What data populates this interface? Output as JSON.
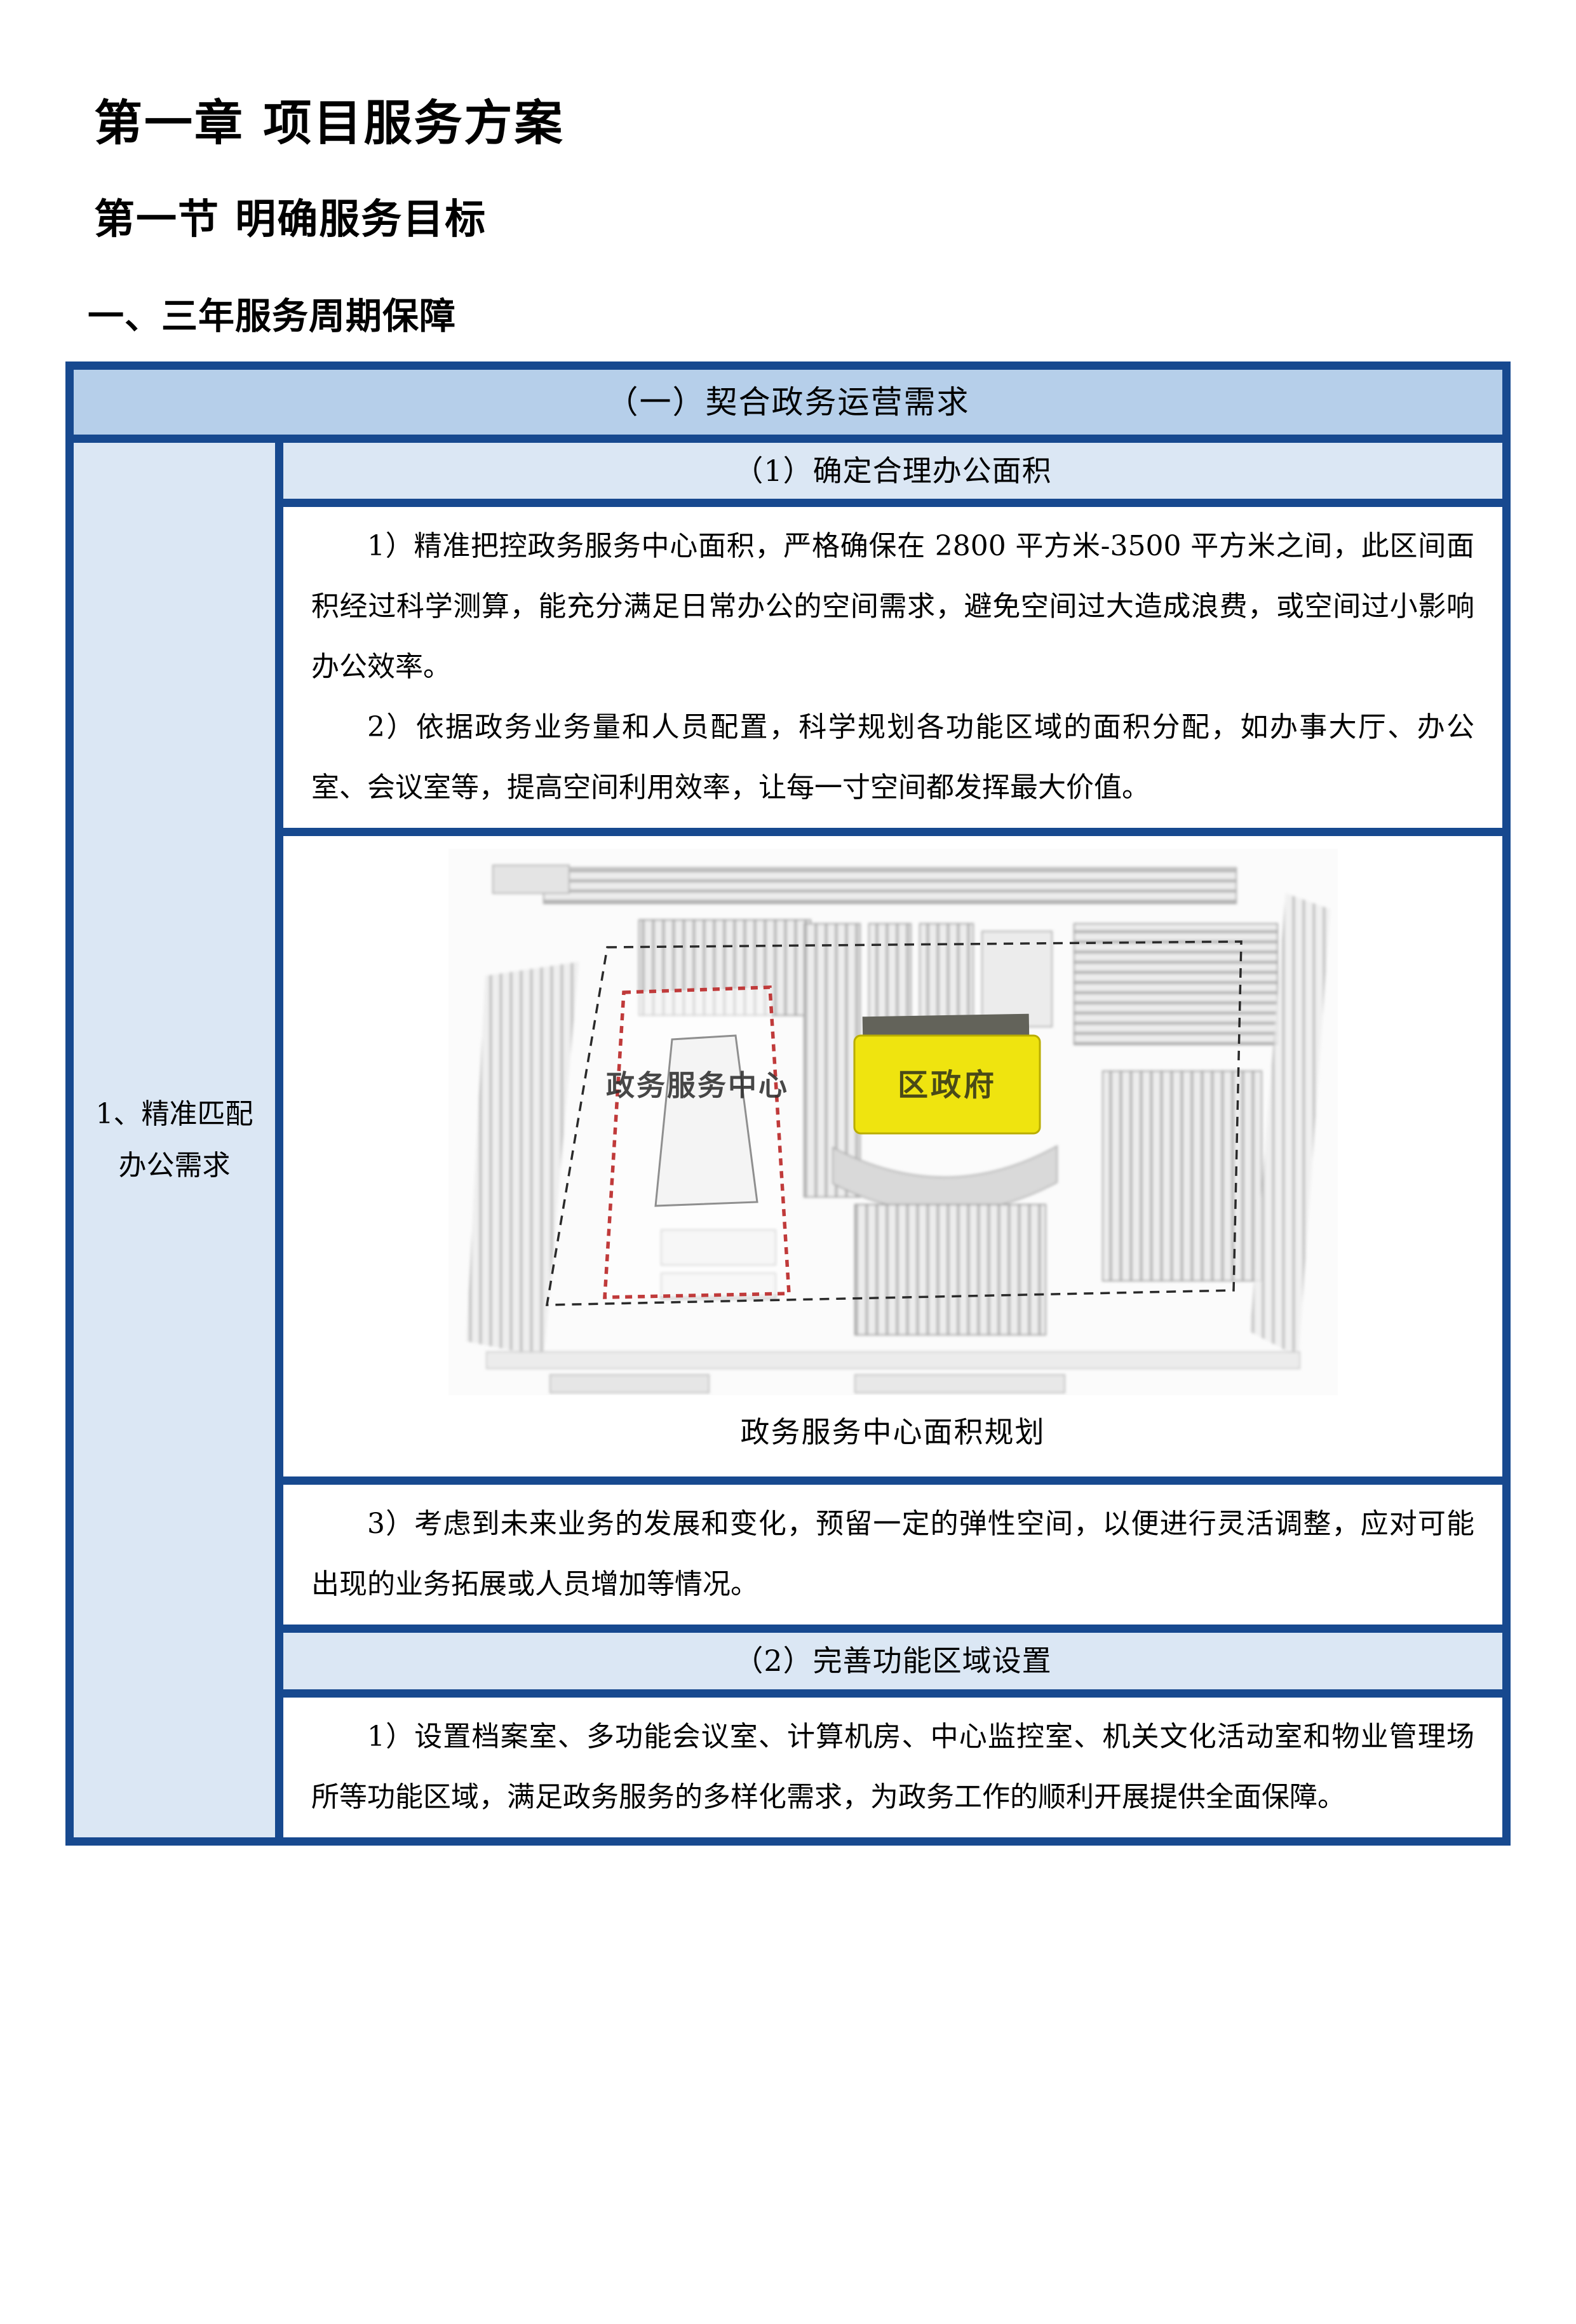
{
  "headings": {
    "chapter": "第一章 项目服务方案",
    "section": "第一节 明确服务目标",
    "sub": "一、三年服务周期保障"
  },
  "table": {
    "header": "（一）契合政务运营需求",
    "left_cell": "1、精准匹配办公需求",
    "section1": {
      "title": "（1）确定合理办公面积",
      "p1": "1）精准把控政务服务中心面积，严格确保在 2800 平方米-3500 平方米之间，此区间面积经过科学测算，能充分满足日常办公的空间需求，避免空间过大造成浪费，或空间过小影响办公效率。",
      "p2": "2）依据政务业务量和人员配置，科学规划各功能区域的面积分配，如办事大厅、办公室、会议室等，提高空间利用效率，让每一寸空间都发挥最大价值。",
      "figure_caption": "政务服务中心面积规划",
      "p3": "3）考虑到未来业务的发展和变化，预留一定的弹性空间，以便进行灵活调整，应对可能出现的业务拓展或人员增加等情况。"
    },
    "section2": {
      "title": "（2）完善功能区域设置",
      "p1": "1）设置档案室、多功能会议室、计算机房、中心监控室、机关文化活动室和物业管理场所等功能区域，满足政务服务的多样化需求，为政务工作的顺利开展提供全面保障。"
    }
  },
  "map": {
    "label_service_center": "政务服务中心",
    "label_district_gov": "区政府",
    "highlight_color": "#efe40f",
    "boundary_red": "#c03a3a",
    "border_blue": "#17498f",
    "header_bg": "#b6cfea",
    "light_bg": "#dbe7f4"
  }
}
